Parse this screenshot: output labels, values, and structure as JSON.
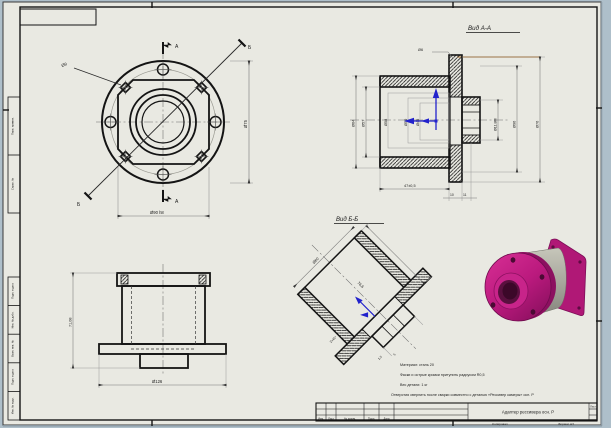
{
  "sheet": {
    "copied_label": "Копировал",
    "format_label": "Формат А3",
    "margin_boxes": {
      "b1": "Перв. примен.",
      "b2": "Справ. №",
      "b3": "Подп. и дата",
      "b4": "Инв. № дубл.",
      "b5": "Взам. инв. №",
      "b6": "Подп. и дата",
      "b7": "Инв. № подл."
    }
  },
  "front_view": {
    "section_a_top": "А",
    "section_a_bottom": "А",
    "section_b_start": "Б",
    "section_b_end": "Б",
    "dim_leader": "Ø9",
    "dim_right": "Ø75",
    "dim_bottom": "Ø90 h8"
  },
  "section_aa": {
    "label": "Вид А-А",
    "dim_left_outer": "Ø64",
    "dim_left_inner": "Ø57",
    "dim_bore_1": "Ø58",
    "dim_bore_2": "Ø50",
    "dim_bore_3": "Ø45",
    "dim_thread": "Ø11,8М",
    "dim_right_mid": "Ø96",
    "dim_right_outer": "Ø76",
    "dim_top_hole": "Ø6",
    "dim_length": "47±0,5",
    "dim_step_1": "10",
    "dim_step_2": "11"
  },
  "side_view": {
    "dim_height": "71,08",
    "dim_bottom": "Ø126"
  },
  "section_bb": {
    "label": "Вид Б-Б",
    "dim_diameter": "Ø60",
    "dim_length": "76,6",
    "dim_chamfer": "2×45°",
    "dim_small_1": "1,5",
    "dim_small_2": "5"
  },
  "notes": {
    "line1": "Материал: сталь 20",
    "line2": "Фаски и острые кромки притупить радиусом R0,5",
    "line3": "Вес детали: 1 кг",
    "line4": "Отверстия сверлить после сварки совместно с деталью «Рессивер камеры» осн. Р"
  },
  "title_block": {
    "part_name": "Адаптер рессивера осн. Р",
    "h_izm": "Изм.",
    "h_list": "Лист",
    "h_doc": "№ докум.",
    "h_podp": "Подп.",
    "h_data": "Дата",
    "sheet_label": "Лист"
  },
  "colors": {
    "paper": "#e9e9e2",
    "background": "#aebfca",
    "line": "#141414",
    "dim": "#8e8e8e",
    "accent_blue": "#2222cc",
    "highlight_tan": "#c49a6b",
    "magenta": "#c01d82",
    "magenta_dark": "#8c1060",
    "gray_body": "#a5a59a"
  }
}
